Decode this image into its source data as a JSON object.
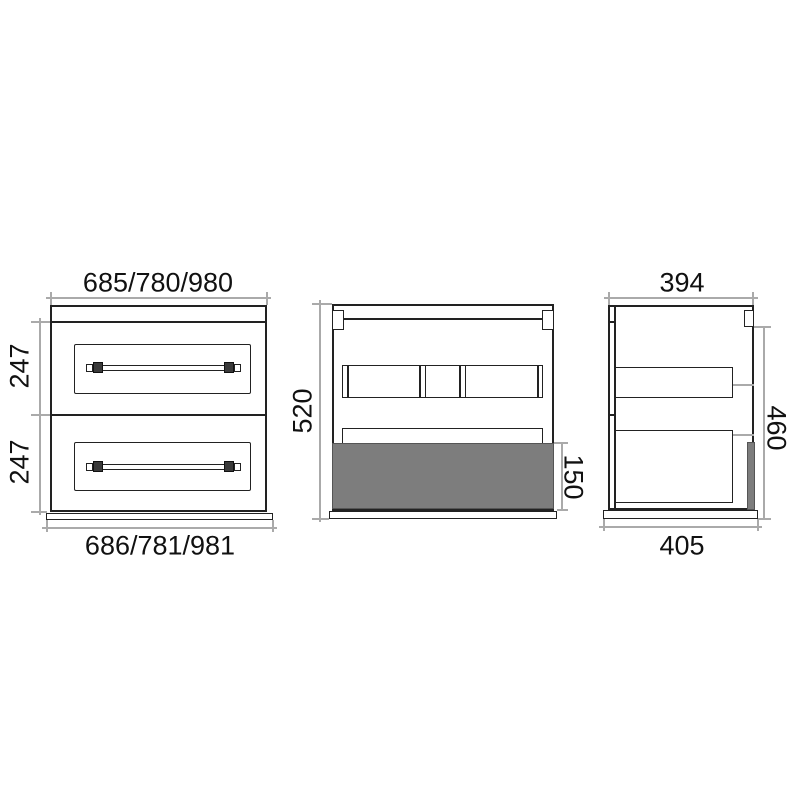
{
  "drawing_title": "cabinet-dimension-drawing",
  "views": {
    "front": {
      "dims": {
        "width_top": "685/780/980",
        "width_bottom": "686/781/981",
        "upper_drawer_height": "247",
        "lower_drawer_height": "247"
      }
    },
    "back": {
      "dims": {
        "carcass_height": "520",
        "bottom_section_height": "150"
      }
    },
    "side": {
      "dims": {
        "depth_top": "394",
        "depth_bottom": "405",
        "side_height": "460"
      }
    }
  },
  "colors": {
    "outline": "#222222",
    "dimension_line": "#aaaaaa",
    "shaded_fill": "#7d7d7d",
    "text": "#111111",
    "background": "#ffffff"
  }
}
